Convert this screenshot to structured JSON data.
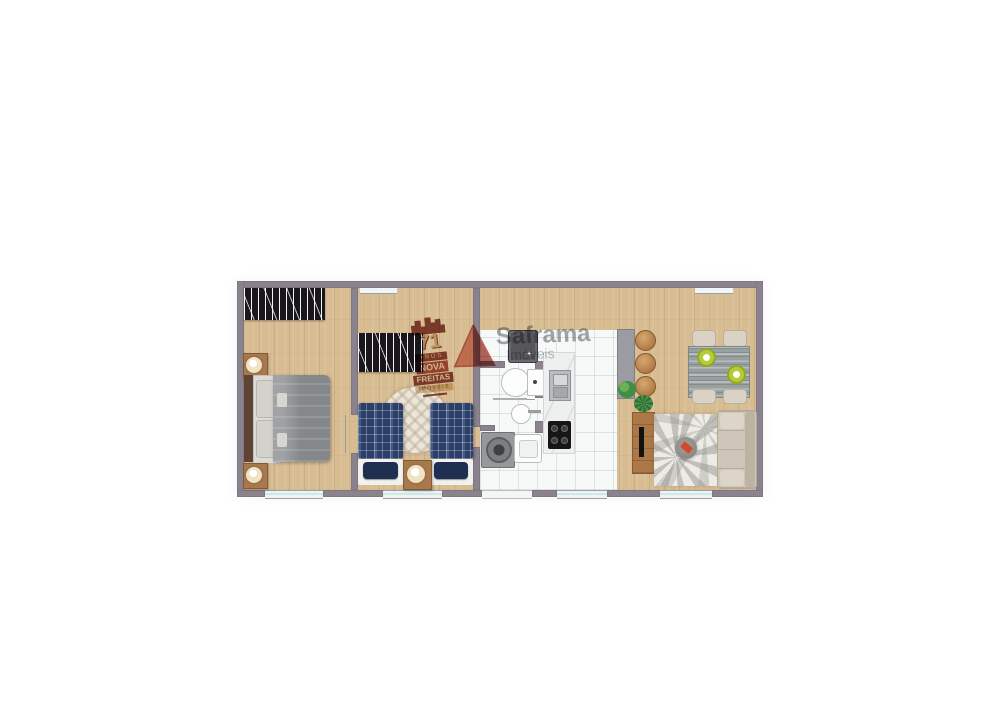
{
  "image_type": "apartment floor plan (top-down render)",
  "logos": {
    "nova_freitas": {
      "years": "71",
      "anos": "ANOS",
      "name_line1": "NOVA",
      "name_line2": "FREITAS",
      "name_line3": "IMÓVEIS"
    },
    "saframa": {
      "name": "Saframa",
      "subtitle": "Imóveis"
    }
  },
  "icons": {
    "fridge_dispenser": "+"
  },
  "colors": {
    "wall": "#8a828c",
    "wood_floor": "#d8bc92",
    "tile_floor": "#f6f9f8",
    "wardrobe": "#19171c",
    "bed1_duvet": "#85888b",
    "bed2_plaid": "#2b3f68",
    "logo_red": "#7b2d26",
    "logo_gray": "#8d9296",
    "sofa": "#cfc6b9",
    "window_glass": "#cfe9e9"
  },
  "floorplan": {
    "rooms": [
      {
        "name": "bedroom-1",
        "furniture": [
          "wardrobe",
          "double-bed",
          "nightstand-with-lamp",
          "nightstand-with-lamp",
          "window"
        ]
      },
      {
        "name": "bedroom-2",
        "furniture": [
          "wardrobe",
          "single-bed",
          "single-bed",
          "round-rug",
          "nightstand-with-lamp",
          "window"
        ]
      },
      {
        "name": "bathroom",
        "furniture": [
          "toilet",
          "round-washbasin",
          "towel-rail"
        ]
      },
      {
        "name": "service-area",
        "furniture": [
          "washing-machine",
          "laundry-tank"
        ]
      },
      {
        "name": "kitchen",
        "furniture": [
          "refrigerator",
          "counter-with-sink",
          "cooktop",
          "window"
        ]
      },
      {
        "name": "dining-area",
        "furniture": [
          "breakfast-counter",
          "stool",
          "stool",
          "stool",
          "dining-table",
          "chair",
          "chair",
          "chair",
          "chair",
          "plant",
          "plant"
        ]
      },
      {
        "name": "living-room",
        "furniture": [
          "tv-rack",
          "tv",
          "patterned-rug",
          "coffee-pouf",
          "sofa",
          "sliding-door"
        ]
      }
    ]
  }
}
